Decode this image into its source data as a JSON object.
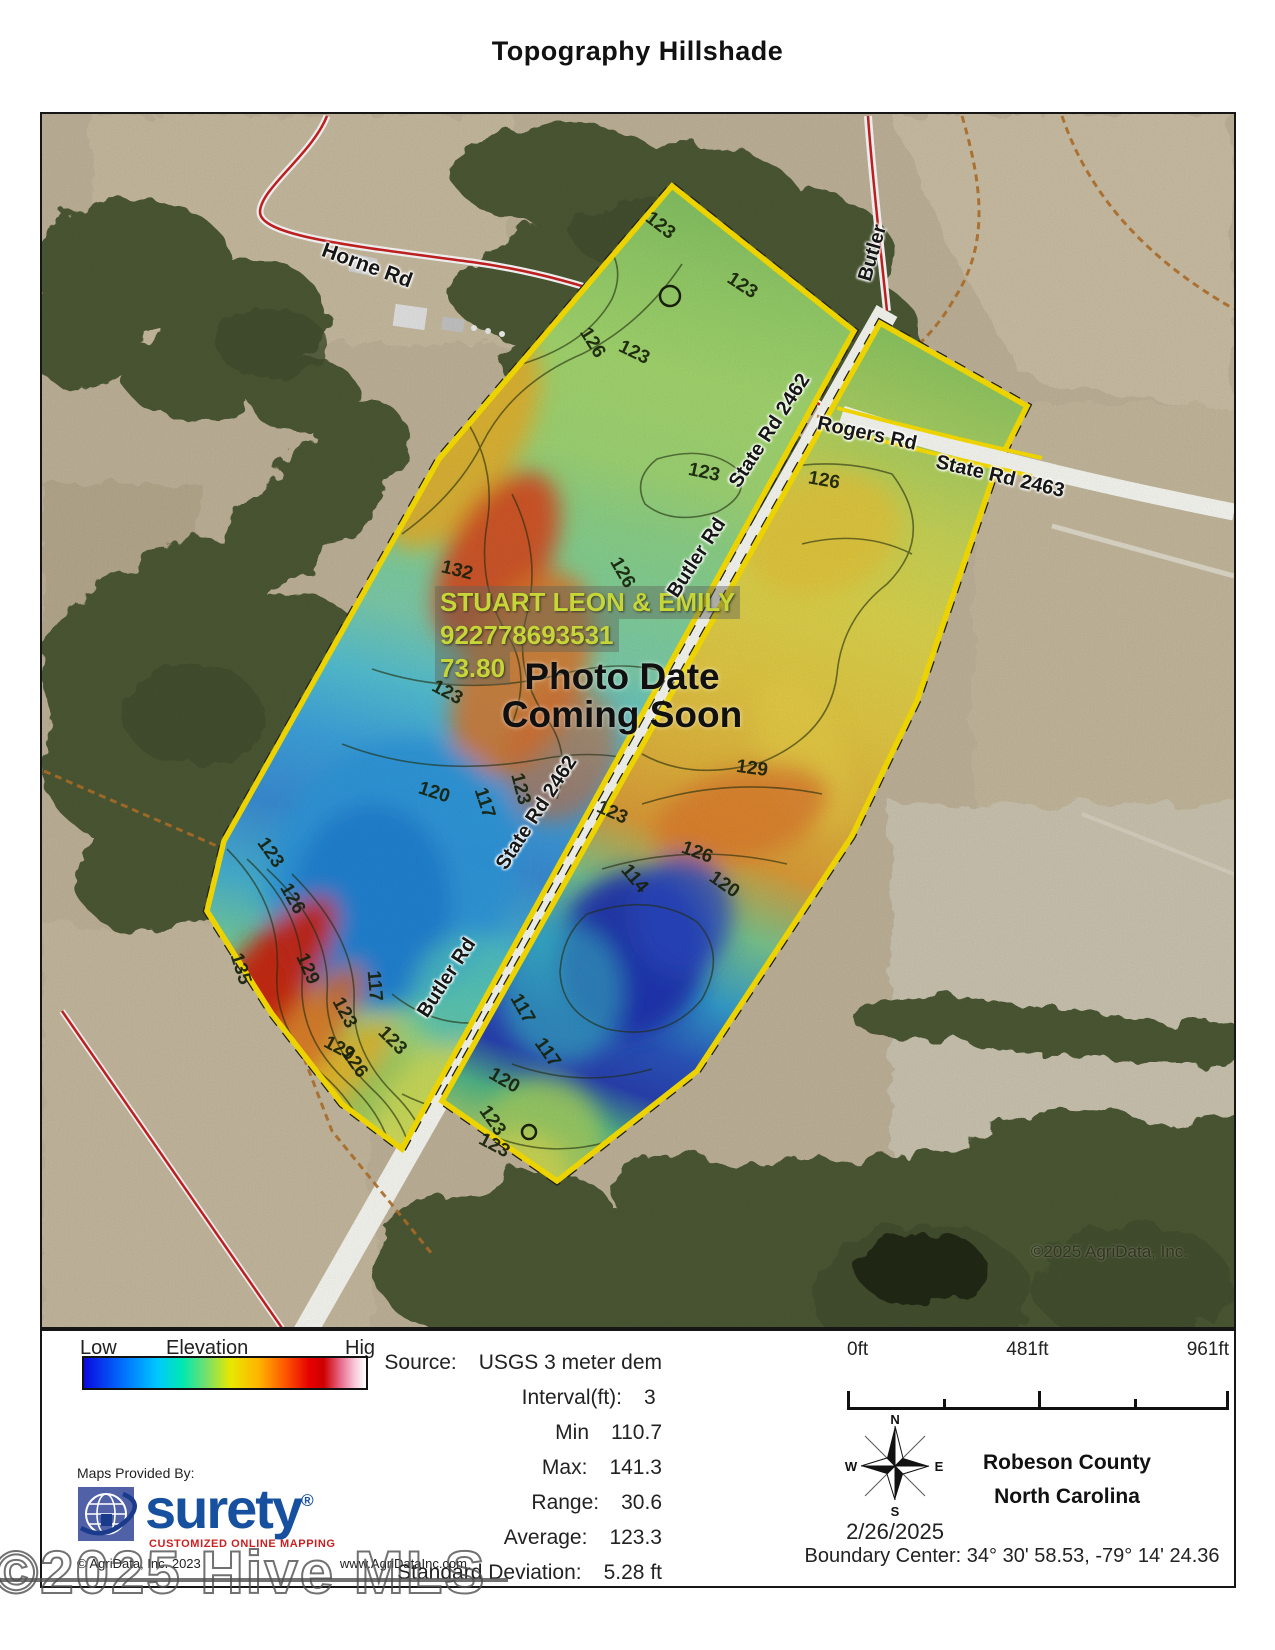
{
  "title": "Topography Hillshade",
  "map": {
    "credit": "©2025 AgriData, Inc.",
    "owner_label": {
      "line1": "STUART LEON & EMILY",
      "line2": "922778693531",
      "line3": "73.80"
    },
    "notice": {
      "line1": "Photo Date",
      "line2": "Coming Soon"
    },
    "colors": {
      "parcel_border": "#ffe400",
      "road_fill": "#ffffff",
      "road_red": "#cc2222"
    },
    "road_labels": [
      {
        "t": "Horne Rd",
        "x": 325,
        "y": 152,
        "r": 20,
        "s": 21
      },
      {
        "t": "Butler",
        "x": 831,
        "y": 139,
        "r": -74,
        "s": 20
      },
      {
        "t": "Rogers Rd",
        "x": 825,
        "y": 320,
        "r": 12,
        "s": 20
      },
      {
        "t": "State Rd 2463",
        "x": 958,
        "y": 363,
        "r": 13,
        "s": 20
      },
      {
        "t": "State Rd 2462",
        "x": 728,
        "y": 317,
        "r": -57,
        "s": 20
      },
      {
        "t": "Butler Rd",
        "x": 655,
        "y": 444,
        "r": -57,
        "s": 20
      },
      {
        "t": "State Rd 2462",
        "x": 495,
        "y": 699,
        "r": -57,
        "s": 20
      },
      {
        "t": "Butler Rd",
        "x": 405,
        "y": 864,
        "r": -57,
        "s": 20
      }
    ],
    "contour_labels": [
      {
        "t": "123",
        "x": 618,
        "y": 112,
        "r": 38
      },
      {
        "t": "123",
        "x": 700,
        "y": 172,
        "r": 33
      },
      {
        "t": "126",
        "x": 550,
        "y": 229,
        "r": 58
      },
      {
        "t": "123",
        "x": 592,
        "y": 239,
        "r": 26
      },
      {
        "t": "123",
        "x": 662,
        "y": 359,
        "r": 12
      },
      {
        "t": "126",
        "x": 782,
        "y": 367,
        "r": 10
      },
      {
        "t": "132",
        "x": 415,
        "y": 457,
        "r": 14
      },
      {
        "t": "126",
        "x": 580,
        "y": 459,
        "r": 60
      },
      {
        "t": "123",
        "x": 405,
        "y": 579,
        "r": 28
      },
      {
        "t": "120",
        "x": 392,
        "y": 679,
        "r": 18
      },
      {
        "t": "117",
        "x": 442,
        "y": 689,
        "r": 72
      },
      {
        "t": "123",
        "x": 478,
        "y": 675,
        "r": 75
      },
      {
        "t": "129",
        "x": 710,
        "y": 655,
        "r": 8
      },
      {
        "t": "123",
        "x": 570,
        "y": 699,
        "r": 24
      },
      {
        "t": "126",
        "x": 655,
        "y": 739,
        "r": 20
      },
      {
        "t": "120",
        "x": 682,
        "y": 771,
        "r": 35
      },
      {
        "t": "114",
        "x": 592,
        "y": 765,
        "r": 50
      },
      {
        "t": "123",
        "x": 228,
        "y": 739,
        "r": 55
      },
      {
        "t": "126",
        "x": 250,
        "y": 785,
        "r": 60
      },
      {
        "t": "135",
        "x": 198,
        "y": 855,
        "r": 72
      },
      {
        "t": "129",
        "x": 265,
        "y": 855,
        "r": 66
      },
      {
        "t": "117",
        "x": 332,
        "y": 872,
        "r": 85
      },
      {
        "t": "123",
        "x": 302,
        "y": 899,
        "r": 62
      },
      {
        "t": "129",
        "x": 297,
        "y": 935,
        "r": 28
      },
      {
        "t": "123",
        "x": 350,
        "y": 927,
        "r": 45
      },
      {
        "t": "126",
        "x": 312,
        "y": 949,
        "r": 55
      },
      {
        "t": "117",
        "x": 480,
        "y": 895,
        "r": 60
      },
      {
        "t": "117",
        "x": 505,
        "y": 939,
        "r": 55
      },
      {
        "t": "120",
        "x": 462,
        "y": 967,
        "r": 30
      },
      {
        "t": "123",
        "x": 450,
        "y": 1007,
        "r": 55
      },
      {
        "t": "123",
        "x": 452,
        "y": 1032,
        "r": 28
      }
    ]
  },
  "legend": {
    "low": "Low",
    "title": "Elevation",
    "high": "Hig",
    "gradient_colors": [
      "#0a0ae0 0%",
      "#0078ff 15%",
      "#00c8ff 26%",
      "#00e8b0 35%",
      "#70e070 43%",
      "#e8e800 52%",
      "#ffb400 62%",
      "#ff5a00 71%",
      "#e60000 80%",
      "#cc0000 85%",
      "#e86a8a 91%",
      "#f8c8d8 96%",
      "#ffffff 100%"
    ],
    "stats": [
      {
        "label": "Source:",
        "value": "USGS 3 meter dem"
      },
      {
        "label": "Interval(ft):",
        "value": "3"
      },
      {
        "label": "Min",
        "value": "110.7"
      },
      {
        "label": "Max:",
        "value": "141.3"
      },
      {
        "label": "Range:",
        "value": "30.6"
      },
      {
        "label": "Average:",
        "value": "123.3"
      },
      {
        "label": "Standard Deviation:",
        "value": "5.28 ft"
      }
    ],
    "scale": {
      "labels": [
        "0ft",
        "481ft",
        "961ft"
      ]
    },
    "compass": {
      "n": "N",
      "s": "S",
      "e": "E",
      "w": "W"
    },
    "date": "2/26/2025",
    "county": "Robeson County",
    "state": "North Carolina",
    "boundary_center": "Boundary Center: 34° 30' 58.53,  -79° 14' 24.36",
    "provider": {
      "label": "Maps Provided By:",
      "name": "surety",
      "reg": "®",
      "tagline": "CUSTOMIZED ONLINE MAPPING",
      "copyright": "© AgriData, Inc. 2023",
      "website": "www.AgriDataInc.com"
    }
  },
  "watermark": "©2025 Hive MLS"
}
